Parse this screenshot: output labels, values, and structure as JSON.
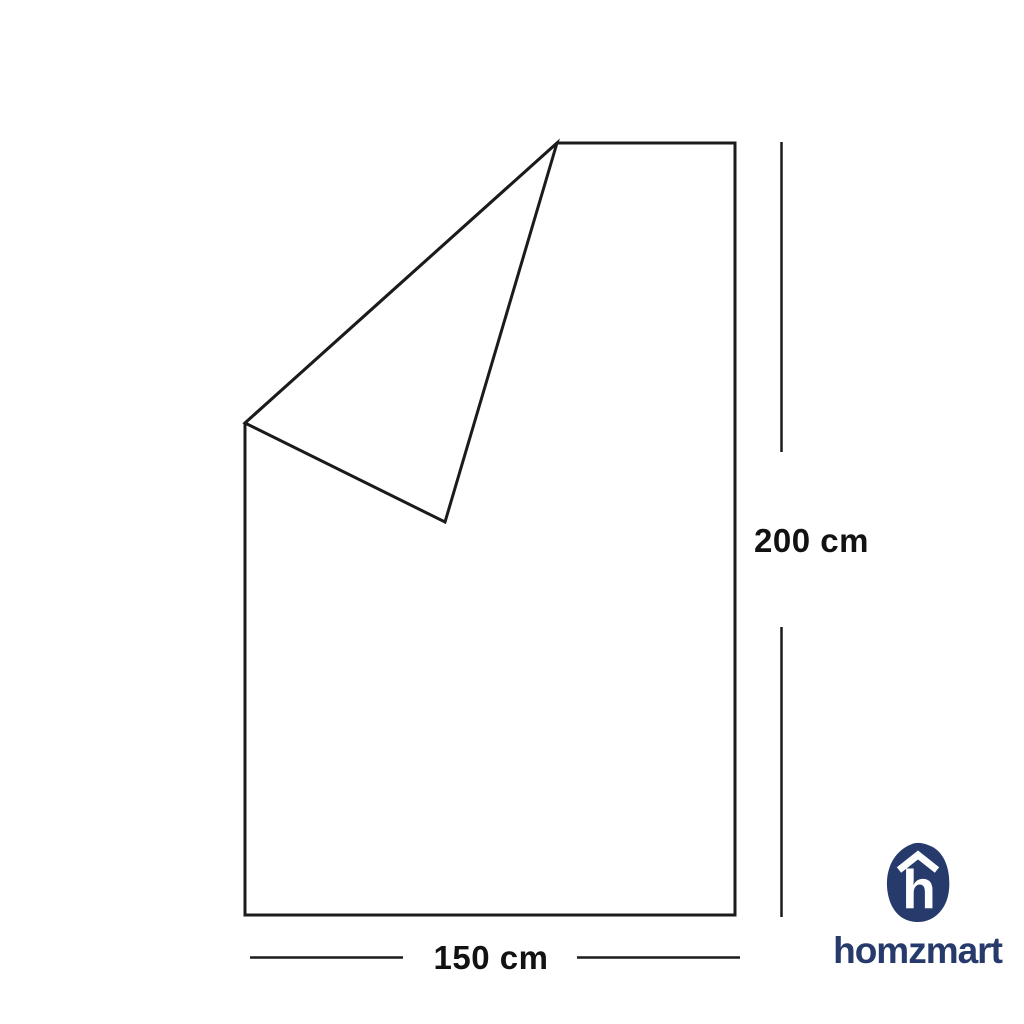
{
  "diagram": {
    "subject": "folded-blanket-outline",
    "height_label": "200 cm",
    "width_label": "150 cm",
    "line_color": "#1b1b1b",
    "fill_color": "#ffffff"
  },
  "brand": {
    "wordmark": "homzmart",
    "monogram": "h",
    "logo_icon": "house-h-blob-icon",
    "color": "#263a6b"
  }
}
